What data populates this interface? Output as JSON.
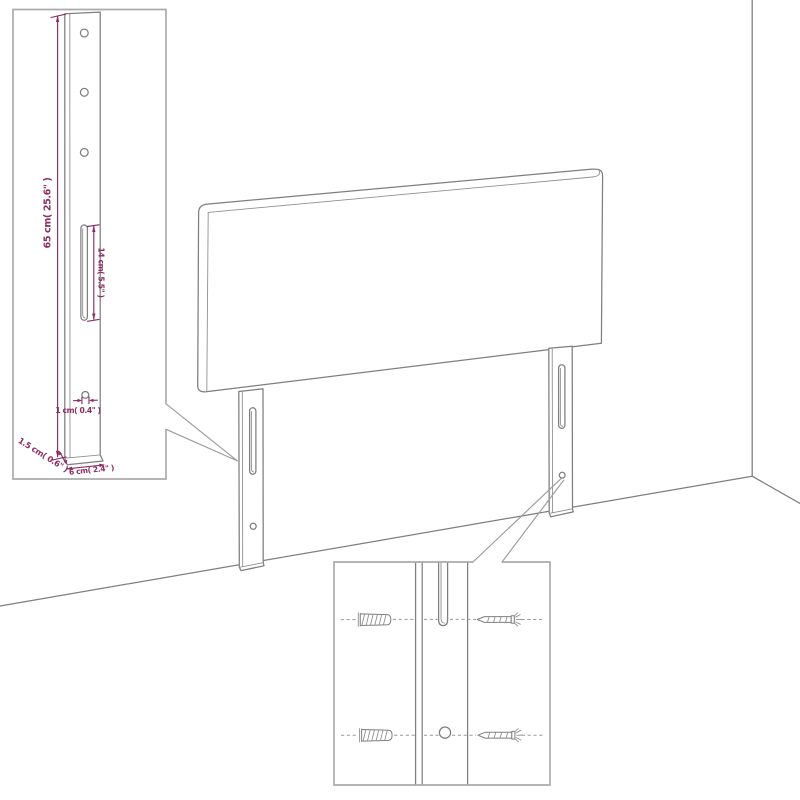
{
  "diagram": {
    "type": "furniture-assembly-diagram",
    "subject": "upholstered headboard with two wall-mount legs shown in a room corner",
    "colors": {
      "background": "#ffffff",
      "drawing_line": "#7e7e7e",
      "inset_border": "#ababab",
      "dimension_text": "#8b2e62"
    },
    "icons": {
      "wall_anchor": "wall-anchor-icon",
      "screw": "screw-icon"
    },
    "inset_leg_detail": {
      "dim_height": "65 cm( 25.6\" )",
      "dim_slot": "14 cm( 5.5\" )",
      "dim_hole": "1 cm( 0.4\" )",
      "dim_depth": "1.5 cm( 0.6\" )",
      "dim_width": "6 cm( 2.4\" )"
    }
  }
}
